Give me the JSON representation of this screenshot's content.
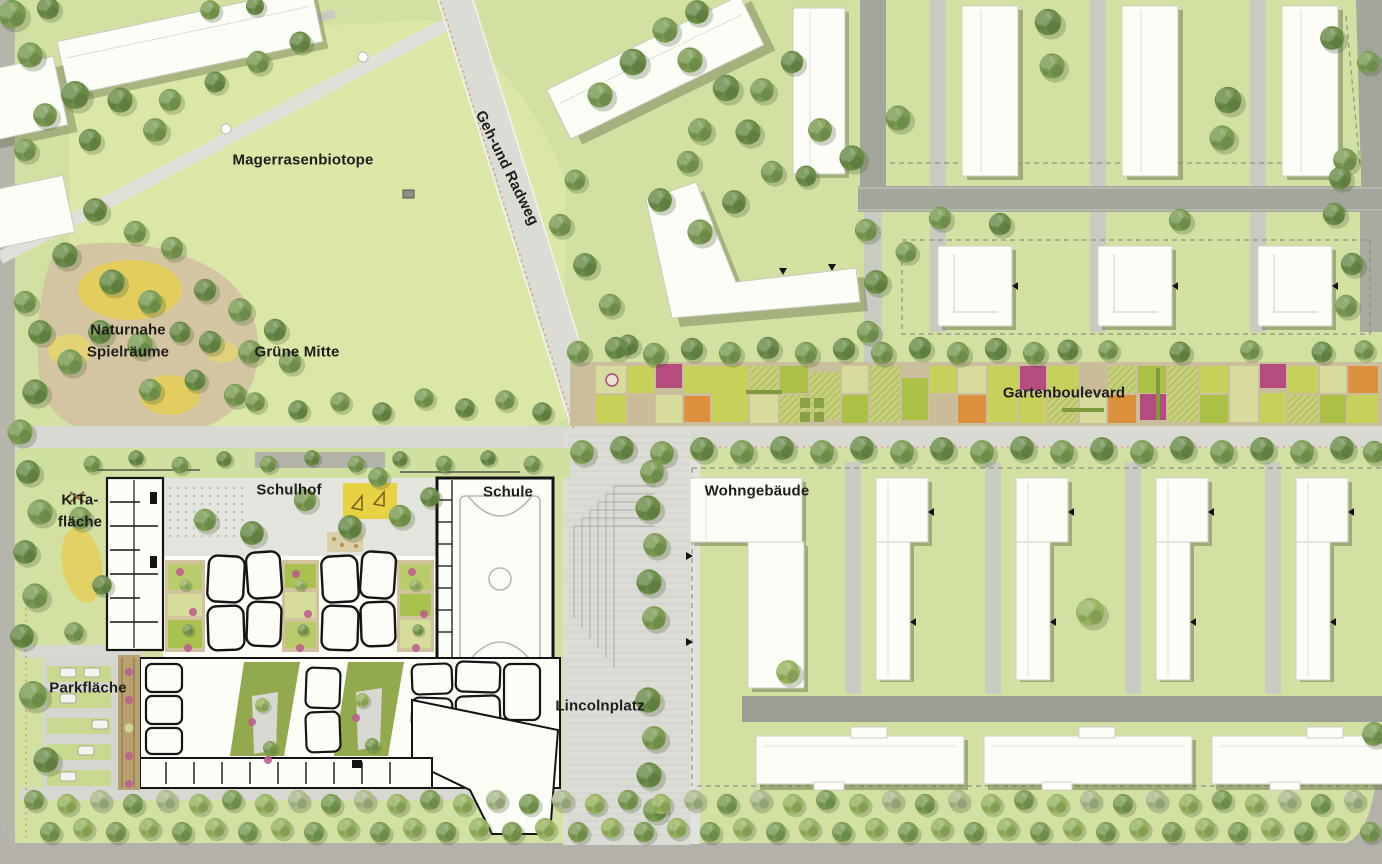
{
  "labels": {
    "magerrasenbiotope": "Magerrasenbiotope",
    "geh_und_radweg": "Geh-und Radweg",
    "naturnahe_spielraeume": {
      "line1": "Naturnahe",
      "line2": "Spielräume"
    },
    "gruene_mitte": "Grüne Mitte",
    "gartenboulevard": "Gartenboulevard",
    "schulhof": "Schulhof",
    "schule": "Schule",
    "kita_flaeche": {
      "line1": "KiTa-",
      "line2": "fläche"
    },
    "wohngebaeude": "Wohngebäude",
    "parkflaeche": "Parkfläche",
    "lincolnplatz": "Lincolnplatz"
  },
  "colors": {
    "grass": "#d2e1a2",
    "meadow": "#dbe7a6",
    "tree_green": "#7b9b52",
    "road_gray": "#a2a69b",
    "path_light": "#d9d9d3",
    "plaza_gray": "#dcdcd6",
    "building_white": "#fdfdf8",
    "plan_wall_black": "#141414",
    "sand_tan": "#d3c5a2",
    "play_yellow": "#e7d243",
    "garden_tan": "#cbbe9c",
    "garden_lime": "#c6d155",
    "garden_green": "#a9c140",
    "garden_magenta": "#b2477c",
    "garden_orange": "#dd8d36",
    "courtyard_olive": "#93a94e"
  }
}
